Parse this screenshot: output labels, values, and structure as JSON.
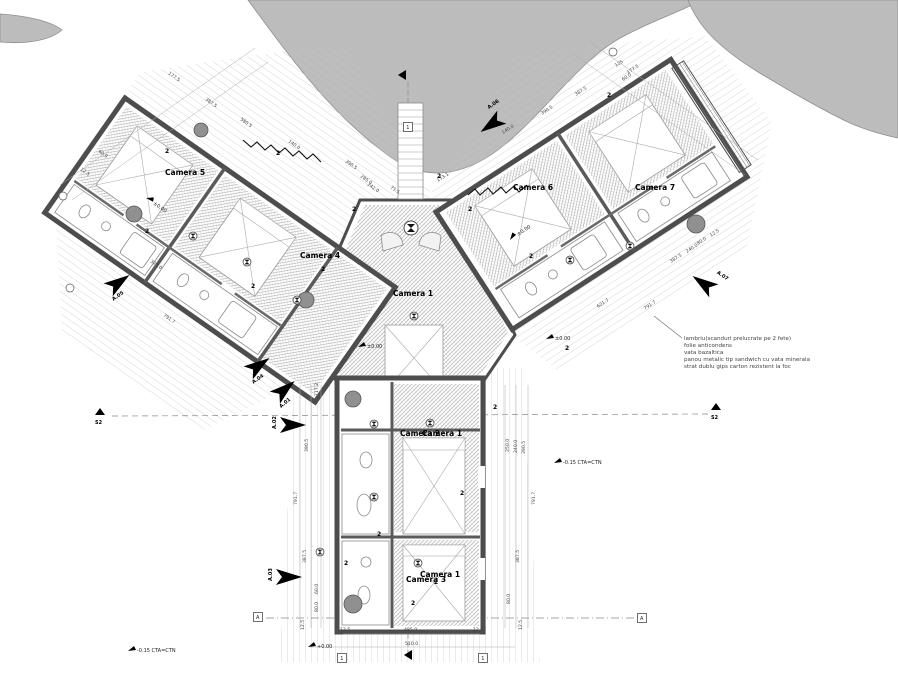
{
  "plan": {
    "rooms": {
      "camera1": "Camera 1",
      "camera2": "Camera 2",
      "camera3": "Camera 3",
      "camera4": "Camera 4",
      "camera5": "Camera 5",
      "camera6": "Camera 6",
      "camera7": "Camera 7"
    },
    "door_tag": "2",
    "grid": {
      "a": "A",
      "one": "1"
    },
    "sections": {
      "a01": "A.01",
      "a02": "A.02",
      "a03": "A.03",
      "a04": "A.04",
      "a05": "A.05",
      "a06": "A.06",
      "a07": "A.07",
      "s2": "S2"
    },
    "elevations": {
      "zero": "±0.00",
      "plus": "+0.00",
      "minus": "-0.15 CTA=CTN"
    },
    "annotation": {
      "lines": [
        "lambriu(scanduri prelucrate pe 2 fete)",
        "folie anticondens",
        "vata bazaltica",
        "panou metalic tip sandwich cu vata minerala",
        "strat dublu gips carton rezistent la foc"
      ]
    },
    "dims": [
      "177.5",
      "387.5",
      "140.0",
      "390.5",
      "285.0",
      "242.0",
      "580.5",
      "323.0",
      "791.7",
      "60.0",
      "12.5",
      "71.5",
      "173.1",
      "140.0",
      "387.5",
      "177.5",
      "390.5",
      "125",
      "60.0",
      "621.7",
      "791.7",
      "387.5",
      "240.0",
      "80.0",
      "12.5",
      "717.2",
      "390.5",
      "791.7",
      "387.5",
      "60.0",
      "80.0",
      "12.5",
      "250.0",
      "240.0",
      "390.5",
      "791.7",
      "387.5",
      "80.0",
      "12.5",
      "12.5",
      "485.0",
      "12.5",
      "510.0"
    ],
    "colors": {
      "wall": "#4d4d4d",
      "terrain": "#b9b9b9",
      "hatch": "#c6c6c6"
    }
  }
}
